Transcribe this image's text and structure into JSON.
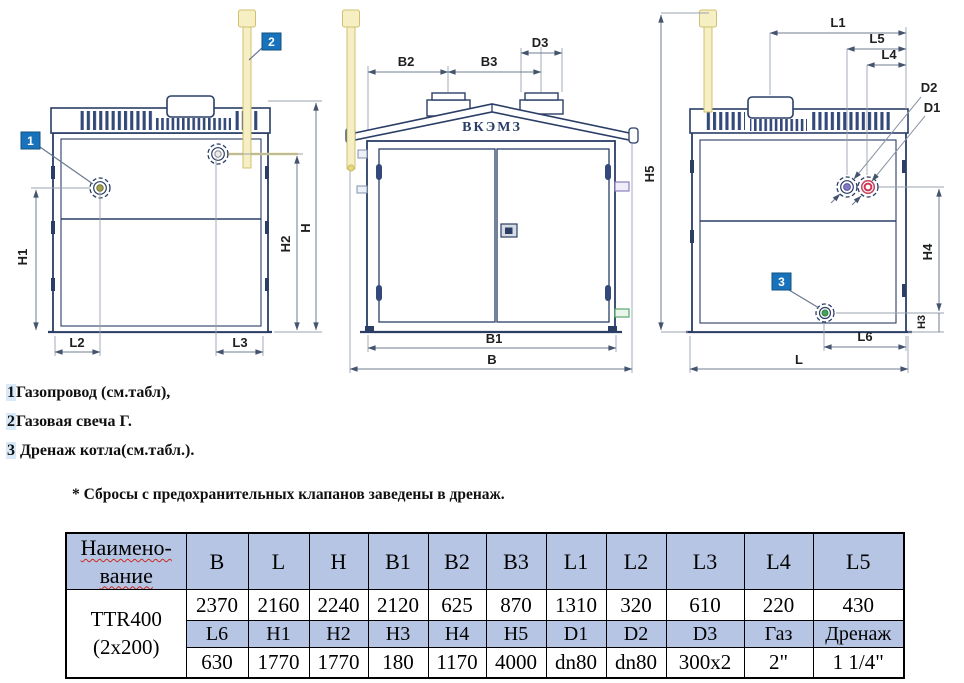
{
  "drawing": {
    "brand_label": "ВКЭМЗ",
    "callouts": {
      "c1": "1",
      "c2": "2",
      "c3": "3"
    },
    "left_view": {
      "h1": "H1",
      "h2": "H2",
      "h": "H",
      "l2": "L2",
      "l3": "L3"
    },
    "front_view": {
      "b2": "B2",
      "b3": "B3",
      "d3": "D3",
      "b1": "B1",
      "b": "B"
    },
    "right_view": {
      "l1": "L1",
      "l5": "L5",
      "l4": "L4",
      "d2": "D2",
      "d1": "D1",
      "h5": "H5",
      "h4": "H4",
      "h3": "H3",
      "l6": "L6",
      "l": "L"
    }
  },
  "legend": {
    "items": [
      {
        "num": "1",
        "text": "Газопровод (см.табл),"
      },
      {
        "num": "2",
        "text": "Газовая свеча Г."
      },
      {
        "num": "3",
        "text": "Дренаж котла(см.табл.)."
      }
    ],
    "footnote": "* Сбросы с предохранительных клапанов заведены в дренаж."
  },
  "table": {
    "name_header": [
      "Наимено-",
      "вание"
    ],
    "model": [
      "TTR400",
      "(2x200)"
    ],
    "dim_headers_1": [
      "B",
      "L",
      "H",
      "B1",
      "B2",
      "B3",
      "L1",
      "L2",
      "L3",
      "L4",
      "L5"
    ],
    "values_1": [
      "2370",
      "2160",
      "2240",
      "2120",
      "625",
      "870",
      "1310",
      "320",
      "610",
      "220",
      "430"
    ],
    "dim_headers_2": [
      "L6",
      "H1",
      "H2",
      "H3",
      "H4",
      "H5",
      "D1",
      "D2",
      "D3",
      "Газ",
      "Дренаж"
    ],
    "values_2": [
      "630",
      "1770",
      "1770",
      "180",
      "1170",
      "4000",
      "dn80",
      "dn80",
      "300x2",
      "2\"",
      "1 1/4\""
    ]
  },
  "colors": {
    "line_navy": "#2a3e66",
    "callout_blue": "#1873bc",
    "table_header_bg": "#b6c5e4",
    "pipe_yellow": "#f6efc4",
    "gas_olive": "#a3a34f",
    "d2_purple": "#837ac2",
    "d1_red": "#cc3355",
    "drain_green": "#47a35c"
  }
}
